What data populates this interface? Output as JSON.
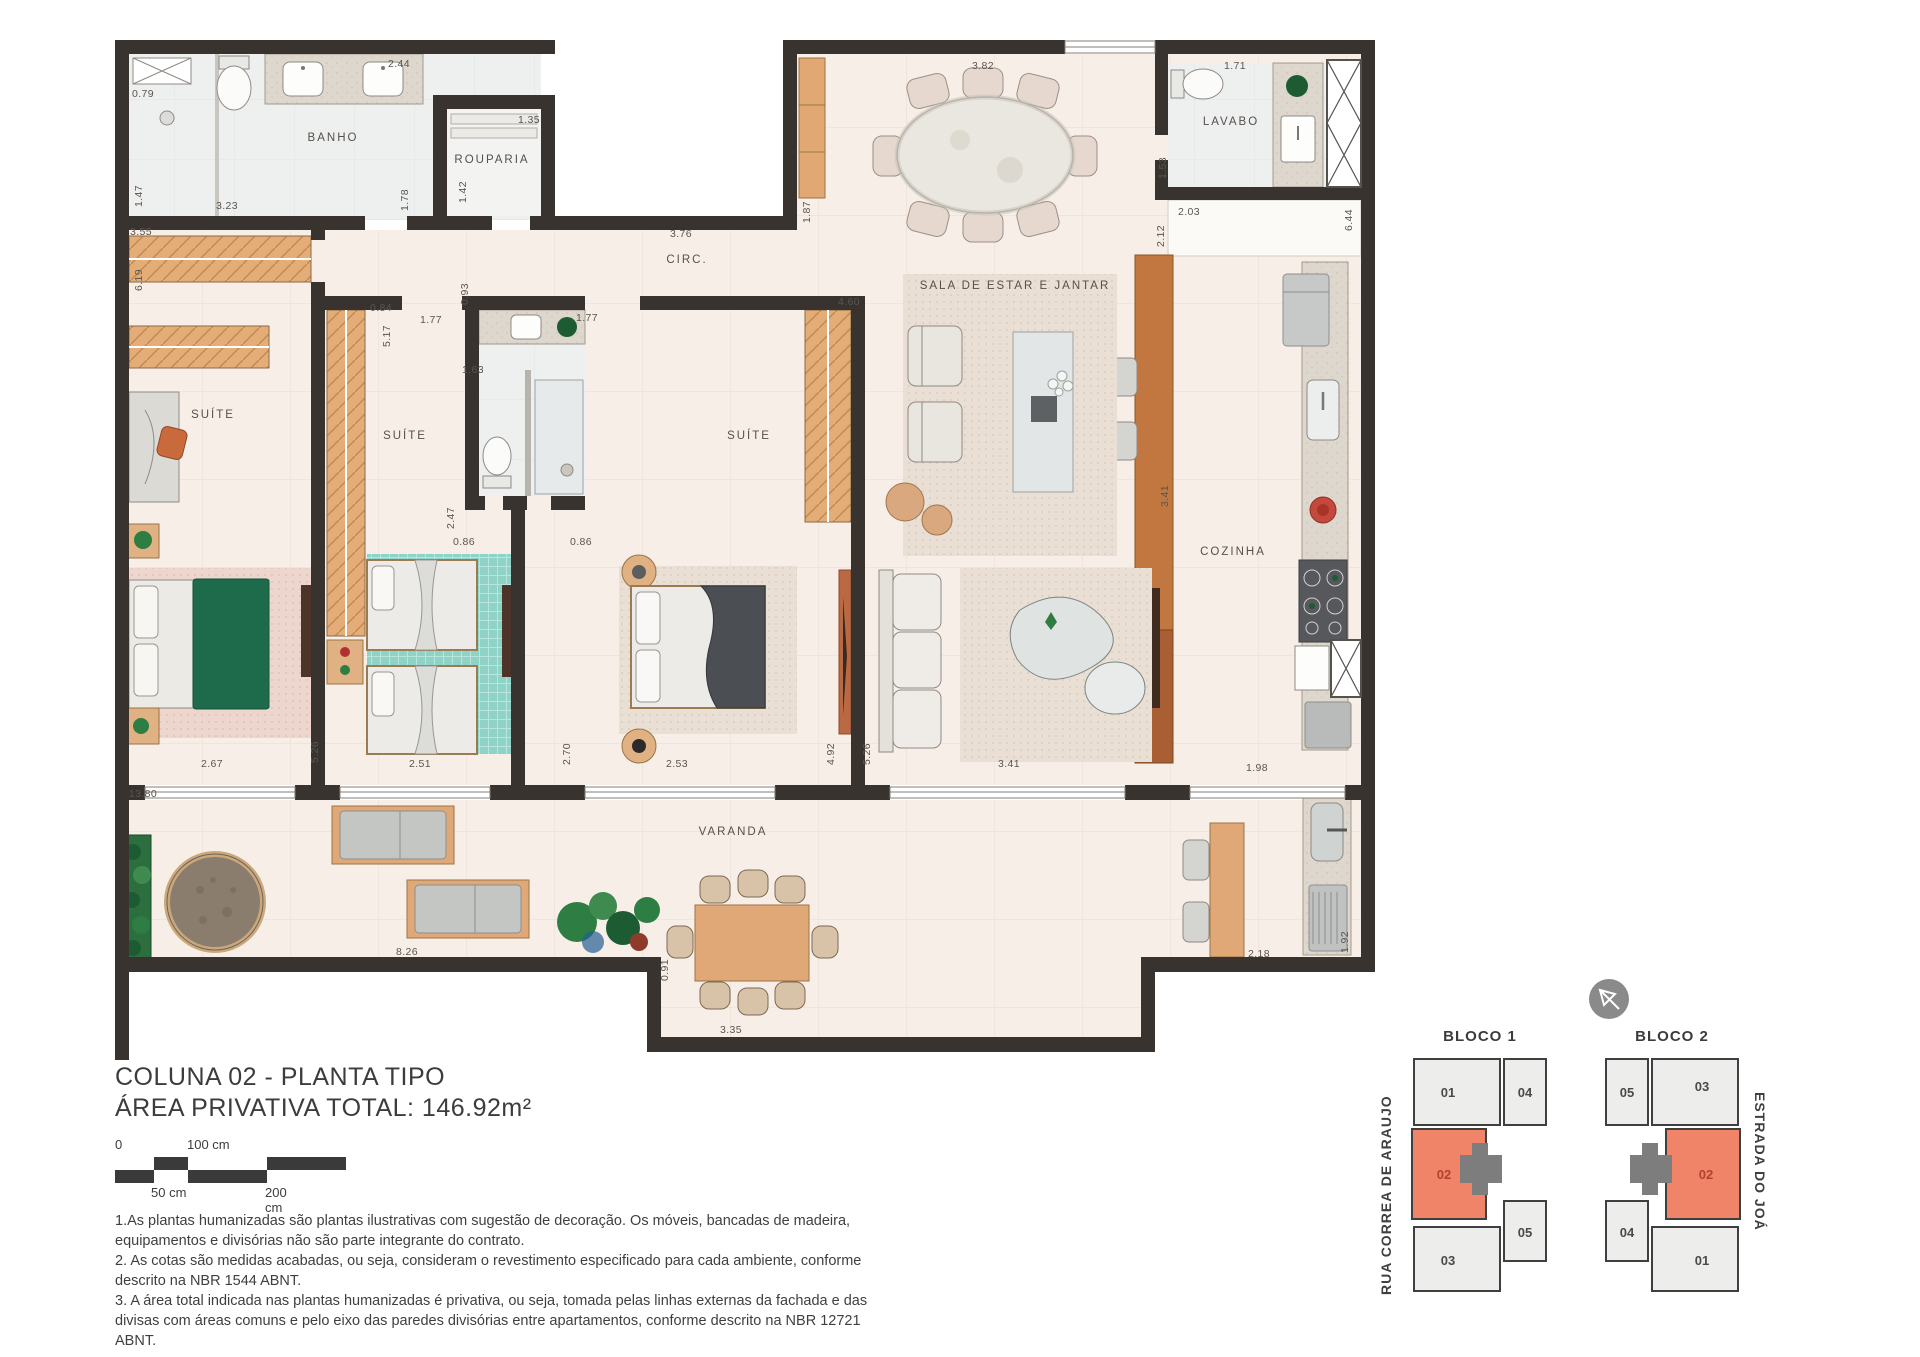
{
  "title_block": {
    "line1": "COLUNA 02 - PLANTA TIPO",
    "line2": "ÁREA PRIVATIVA TOTAL: 146.92m²"
  },
  "scale_bar": {
    "zero": "0",
    "l100": "100 cm",
    "l50": "50 cm",
    "l200": "200 cm"
  },
  "notes": [
    "1.As plantas humanizadas são plantas ilustrativas com sugestão de decoração. Os móveis, bancadas de madeira, equipamentos e divisórias não são parte integrante do contrato.",
    "2. As cotas são medidas acabadas, ou seja, consideram o revestimento especificado para cada ambiente, conforme descrito na NBR 1544 ABNT.",
    "3. A área total indicada nas plantas humanizadas é privativa, ou seja, tomada pelas linhas externas da fachada e das divisas com áreas comuns e pelo eixo das paredes divisórias entre apartamentos, conforme descrito na NBR 12721 ABNT."
  ],
  "plan": {
    "rooms": [
      {
        "id": "banho",
        "label": "BANHO",
        "x": 218,
        "y": 98
      },
      {
        "id": "rouparia",
        "label": "ROUPARIA",
        "x": 377,
        "y": 120
      },
      {
        "id": "circ",
        "label": "CIRC.",
        "x": 572,
        "y": 220
      },
      {
        "id": "sala",
        "label": "SALA DE ESTAR E JANTAR",
        "x": 900,
        "y": 246
      },
      {
        "id": "lavabo",
        "label": "LAVABO",
        "x": 1116,
        "y": 82
      },
      {
        "id": "cozinha",
        "label": "COZINHA",
        "x": 1118,
        "y": 512
      },
      {
        "id": "suite-1",
        "label": "SUÍTE",
        "x": 98,
        "y": 375
      },
      {
        "id": "suite-2",
        "label": "SUÍTE",
        "x": 290,
        "y": 396
      },
      {
        "id": "suite-3",
        "label": "SUÍTE",
        "x": 634,
        "y": 396
      },
      {
        "id": "varanda",
        "label": "VARANDA",
        "x": 618,
        "y": 792
      }
    ],
    "dims": [
      {
        "v": "2.44",
        "x": 284,
        "y": 24,
        "r": 0
      },
      {
        "v": "0.79",
        "x": 28,
        "y": 54,
        "r": 0
      },
      {
        "v": "1.35",
        "x": 414,
        "y": 80,
        "r": 0
      },
      {
        "v": "3.82",
        "x": 868,
        "y": 26,
        "r": 0
      },
      {
        "v": "1.71",
        "x": 1120,
        "y": 26,
        "r": 0
      },
      {
        "v": "3.23",
        "x": 112,
        "y": 166,
        "r": 0
      },
      {
        "v": "1.47",
        "x": 24,
        "y": 156,
        "r": 1
      },
      {
        "v": "1.78",
        "x": 290,
        "y": 160,
        "r": 1
      },
      {
        "v": "1.42",
        "x": 348,
        "y": 152,
        "r": 1
      },
      {
        "v": "1.87",
        "x": 692,
        "y": 172,
        "r": 1
      },
      {
        "v": "3.76",
        "x": 566,
        "y": 194,
        "r": 0
      },
      {
        "v": "1.53",
        "x": 1048,
        "y": 128,
        "r": 1
      },
      {
        "v": "2.03",
        "x": 1074,
        "y": 172,
        "r": 0
      },
      {
        "v": "2.12",
        "x": 1046,
        "y": 196,
        "r": 1
      },
      {
        "v": "6.44",
        "x": 1234,
        "y": 180,
        "r": 1
      },
      {
        "v": "3.55",
        "x": 26,
        "y": 192,
        "r": 0
      },
      {
        "v": "6.19",
        "x": 24,
        "y": 240,
        "r": 1
      },
      {
        "v": "0.84",
        "x": 266,
        "y": 268,
        "r": 0
      },
      {
        "v": "0.93",
        "x": 350,
        "y": 254,
        "r": 1
      },
      {
        "v": "5.17",
        "x": 272,
        "y": 296,
        "r": 1
      },
      {
        "v": "1.77",
        "x": 316,
        "y": 280,
        "r": 0
      },
      {
        "v": "1.63",
        "x": 358,
        "y": 330,
        "r": 0
      },
      {
        "v": "1.77",
        "x": 472,
        "y": 278,
        "r": 0
      },
      {
        "v": "4.60",
        "x": 734,
        "y": 262,
        "r": 0
      },
      {
        "v": "2.47",
        "x": 336,
        "y": 478,
        "r": 1
      },
      {
        "v": "0.86",
        "x": 349,
        "y": 502,
        "r": 0
      },
      {
        "v": "0.86",
        "x": 466,
        "y": 502,
        "r": 0
      },
      {
        "v": "3.41",
        "x": 1050,
        "y": 456,
        "r": 1
      },
      {
        "v": "2.67",
        "x": 97,
        "y": 724,
        "r": 0
      },
      {
        "v": "5.26",
        "x": 200,
        "y": 712,
        "r": 1
      },
      {
        "v": "2.51",
        "x": 305,
        "y": 724,
        "r": 0
      },
      {
        "v": "2.70",
        "x": 452,
        "y": 714,
        "r": 1
      },
      {
        "v": "2.53",
        "x": 562,
        "y": 724,
        "r": 0
      },
      {
        "v": "4.92",
        "x": 716,
        "y": 714,
        "r": 1
      },
      {
        "v": "5.26",
        "x": 752,
        "y": 714,
        "r": 1
      },
      {
        "v": "3.41",
        "x": 894,
        "y": 724,
        "r": 0
      },
      {
        "v": "1.98",
        "x": 1142,
        "y": 728,
        "r": 0
      },
      {
        "v": "13.80",
        "x": 28,
        "y": 754,
        "r": 0
      },
      {
        "v": "8.26",
        "x": 292,
        "y": 912,
        "r": 0
      },
      {
        "v": "0.91",
        "x": 550,
        "y": 930,
        "r": 1
      },
      {
        "v": "3.35",
        "x": 616,
        "y": 990,
        "r": 0
      },
      {
        "v": "2.18",
        "x": 1144,
        "y": 914,
        "r": 0
      },
      {
        "v": "1.92",
        "x": 1230,
        "y": 902,
        "r": 1
      }
    ]
  },
  "keyplan": {
    "bloco1": {
      "label": "BLOCO 1",
      "units": [
        {
          "n": "01"
        },
        {
          "n": "04"
        },
        {
          "n": "02"
        },
        {
          "n": "05"
        },
        {
          "n": "03"
        }
      ]
    },
    "bloco2": {
      "label": "BLOCO 2",
      "units": [
        {
          "n": "05"
        },
        {
          "n": "03"
        },
        {
          "n": "02"
        },
        {
          "n": "04"
        },
        {
          "n": "01"
        }
      ]
    },
    "street_left": "RUA CORREA DE ARAUJO",
    "street_right": "ESTRADA DO JOÁ",
    "highlight_unit": "02",
    "colors": {
      "highlight": "#ef8468",
      "unit_fill": "#ededeb",
      "core": "#7d7d7d",
      "outline": "#3f3f3f"
    }
  },
  "palette": {
    "wall": "#38332f",
    "floor_warm": "#f7efe7",
    "floor_cool": "#eef0f0",
    "granite": "#ded7cd",
    "wood": "#e2a873",
    "wood_dark": "#c1773f",
    "rug_pink": "#ecd6cd",
    "rug_teal": "#8fd2c6",
    "rug_beige": "#eadfd4",
    "blanket_green": "#1e6b4c",
    "blanket_gray": "#4b4e53",
    "plant": "#2e7d43"
  }
}
